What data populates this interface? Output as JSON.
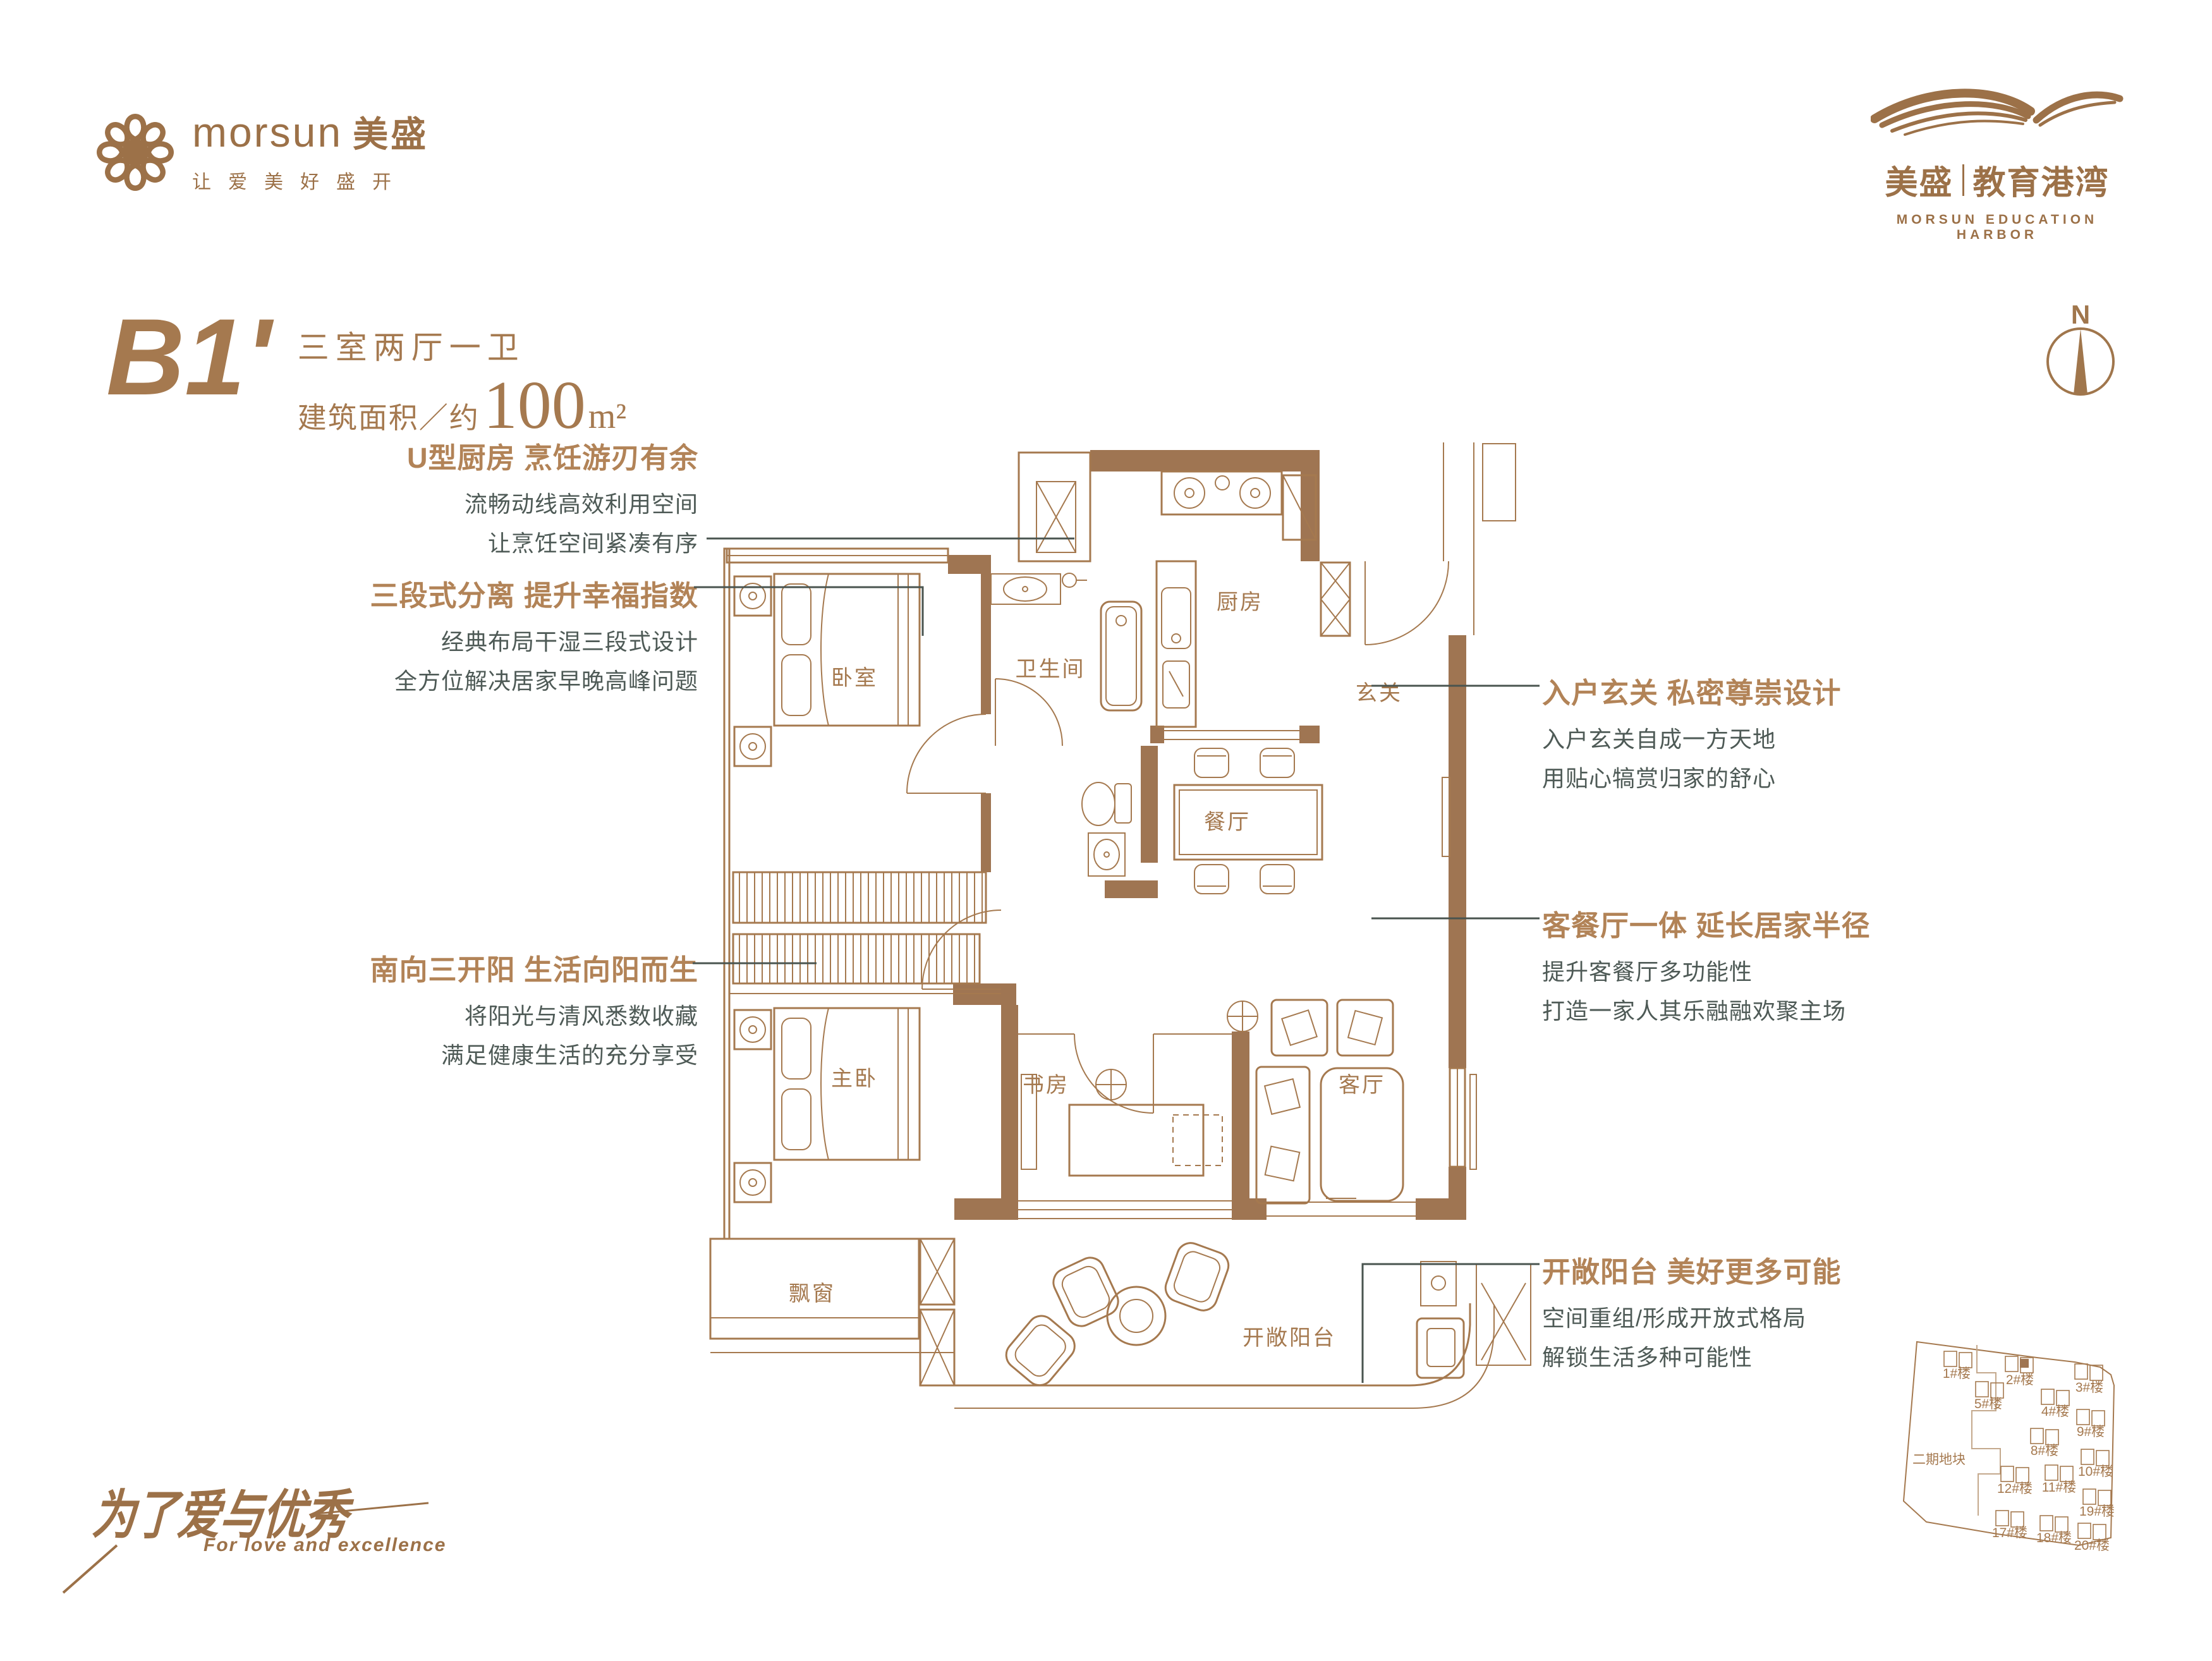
{
  "header": {
    "logo_left": {
      "en": "morsun",
      "cn": "美盛",
      "tagline": "让爱美好盛开"
    },
    "logo_right": {
      "cn_brand": "美盛",
      "cn_sub": "教育港湾",
      "en": "MORSUN EDUCATION HARBOR"
    }
  },
  "unit": {
    "code": "B1'",
    "layout": "三室两厅一卫",
    "area_prefix": "建筑面积／约",
    "area_value": "100",
    "area_unit": "m²"
  },
  "compass": {
    "label": "N"
  },
  "features_left": [
    {
      "title": "U型厨房 烹饪游刃有余",
      "line1": "流畅动线高效利用空间",
      "line2": "让烹饪空间紧凑有序"
    },
    {
      "title": "三段式分离 提升幸福指数",
      "line1": "经典布局干湿三段式设计",
      "line2": "全方位解决居家早晚高峰问题"
    },
    {
      "title": "南向三开阳 生活向阳而生",
      "line1": "将阳光与清风悉数收藏",
      "line2": "满足健康生活的充分享受"
    }
  ],
  "features_right": [
    {
      "title": "入户玄关 私密尊崇设计",
      "line1": "入户玄关自成一方天地",
      "line2": "用贴心犒赏归家的舒心"
    },
    {
      "title": "客餐厅一体 延长居家半径",
      "line1": "提升客餐厅多功能性",
      "line2": "打造一家人其乐融融欢聚主场"
    },
    {
      "title": "开敞阳台 美好更多可能",
      "line1": "空间重组/形成开放式格局",
      "line2": "解锁生活多种可能性"
    }
  ],
  "plan": {
    "rooms": {
      "bedroom": "卧室",
      "bathroom": "卫生间",
      "kitchen": "厨房",
      "foyer": "玄关",
      "dining": "餐厅",
      "master_bedroom": "主卧",
      "study": "书房",
      "living_room": "客厅",
      "bay_window": "飘窗",
      "balcony": "开敞阳台"
    }
  },
  "slogan": {
    "cn": "为了爱与优秀",
    "en": "For love and excellence"
  },
  "site_plan": {
    "phase": "二期地块",
    "buildings": [
      "1#楼",
      "2#楼",
      "3#楼",
      "5#楼",
      "4#楼",
      "9#楼",
      "8#楼",
      "10#楼",
      "12#楼",
      "11#楼",
      "19#楼",
      "17#楼",
      "18#楼",
      "20#楼"
    ]
  },
  "colors": {
    "brand_brown": "#9c7148",
    "wall_brown": "#9f7552",
    "line_brown": "#a5794f",
    "title_brown": "#b28357",
    "body_gray": "#4e5a56"
  }
}
